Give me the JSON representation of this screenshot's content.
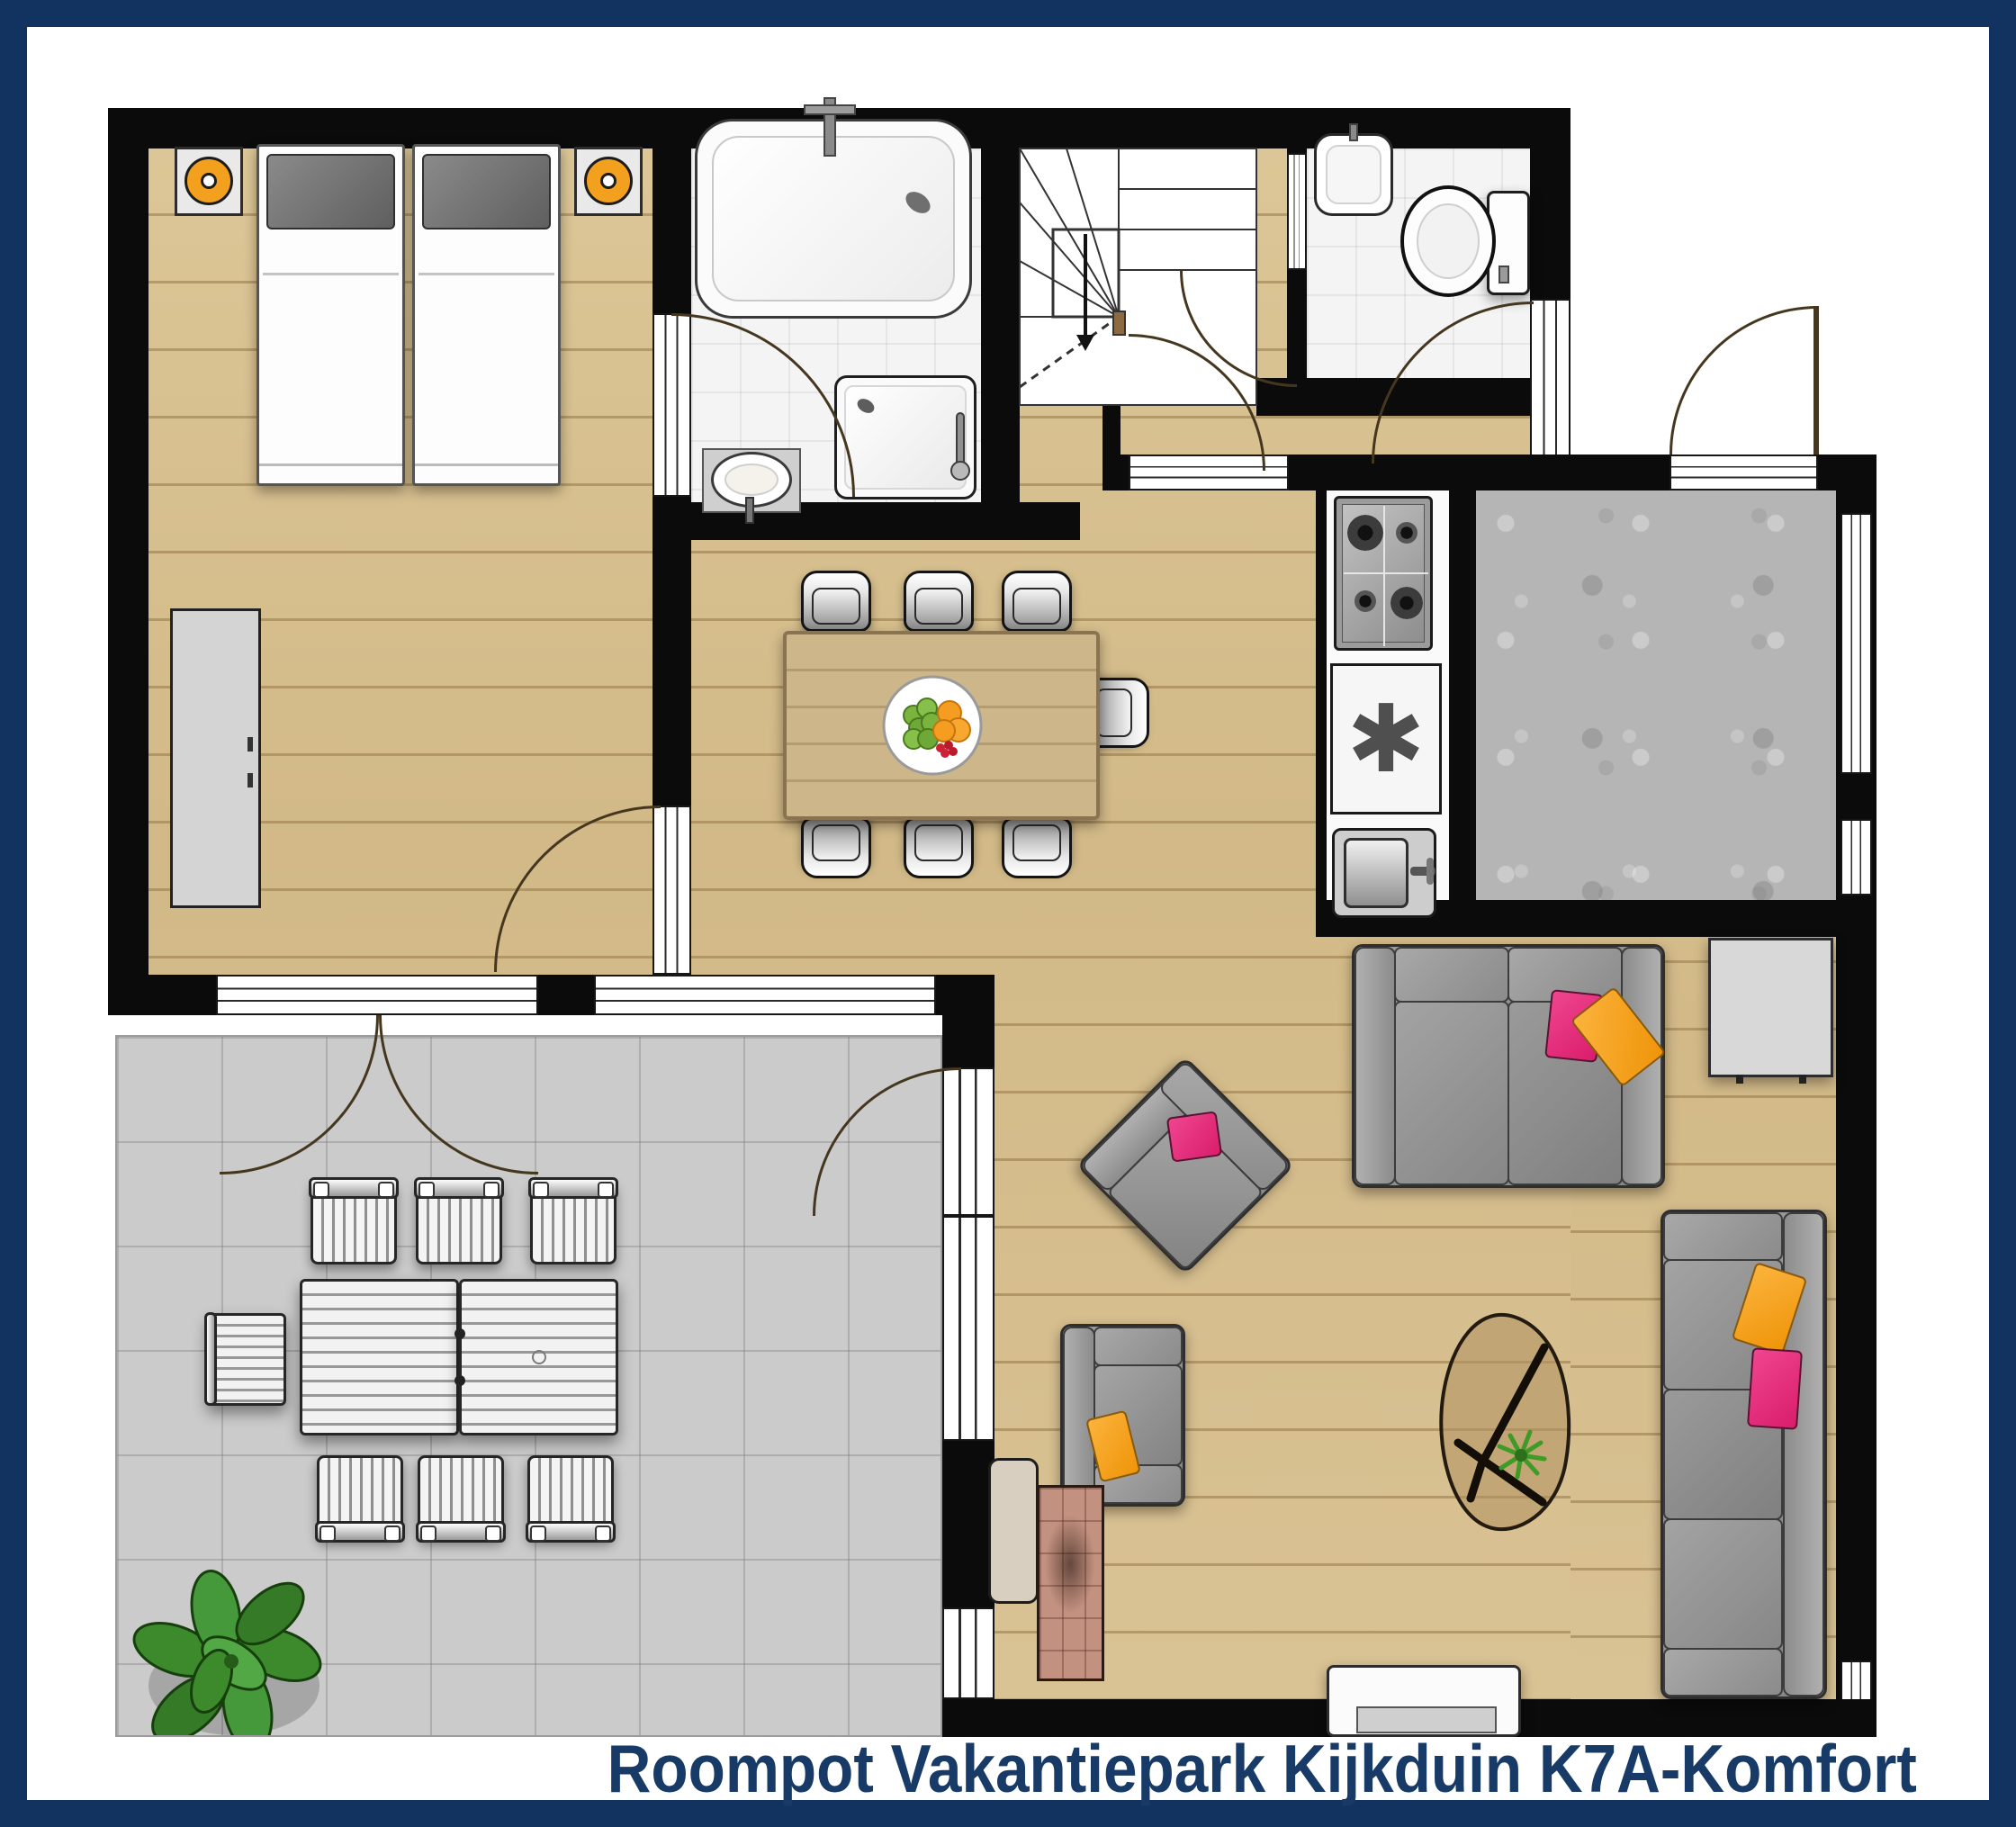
{
  "title": {
    "text": "Roompot Vakantiepark Kijkduin K7A-Komfort"
  },
  "kitchen": {
    "freezer_glyph": "✱"
  },
  "colors": {
    "frame_navy": "#12335f",
    "title_navy": "#173a66",
    "wall_black": "#0b0b0b",
    "wood_floor": "#d6bd8e",
    "terrace_gray": "#cbcbcb",
    "storage_gray": "#b5b5b5",
    "bathroom_tile": "#f4f4f4",
    "accent_pink": "#e8307c",
    "accent_orange": "#f2a21b",
    "lamp_orange": "#f2a01e",
    "plant_green": "#3c8a2c"
  },
  "rooms": [
    {
      "name": "bedroom"
    },
    {
      "name": "bathroom"
    },
    {
      "name": "stairs"
    },
    {
      "name": "hall"
    },
    {
      "name": "toilet"
    },
    {
      "name": "kitchen"
    },
    {
      "name": "storage-room"
    },
    {
      "name": "dining-area"
    },
    {
      "name": "living-room"
    },
    {
      "name": "terrace"
    }
  ]
}
